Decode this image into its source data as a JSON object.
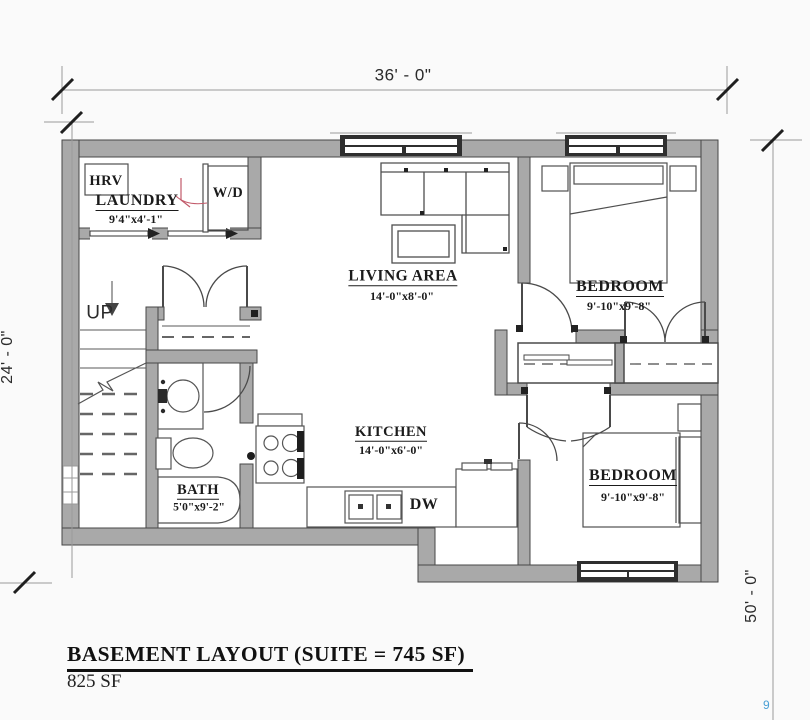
{
  "colors": {
    "wall_fill": "#a9a9a9",
    "line": "#4a4a4a",
    "window_dark": "#2f2f2f",
    "accent_red": "#c25a6a",
    "accent_blue": "#4aa0d5"
  },
  "dimensions": {
    "top": "36' - 0\"",
    "left": "24' - 0\"",
    "right": "50' - 0\""
  },
  "rooms": {
    "laundry": {
      "label": "LAUNDRY",
      "dims": "9'4\"x4'-1\""
    },
    "living": {
      "label": "LIVING AREA",
      "dims": "14'-0\"x8'-0\""
    },
    "kitchen": {
      "label": "KITCHEN",
      "dims": "14'-0\"x6'-0\""
    },
    "bath": {
      "label": "BATH",
      "dims": "5'0\"x9'-2\""
    },
    "bedroom1": {
      "label": "BEDROOM",
      "dims": "9'-10\"x9'-8\""
    },
    "bedroom2": {
      "label": "BEDROOM",
      "dims": "9'-10\"x9'-8\""
    }
  },
  "labels": {
    "hrv": "HRV",
    "wd": "W/D",
    "up": "UP",
    "dw": "DW"
  },
  "title_block": {
    "main": "BASEMENT LAYOUT (SUITE = 745 SF)",
    "area": "825 SF"
  },
  "artifact": {
    "glyph": "9"
  }
}
